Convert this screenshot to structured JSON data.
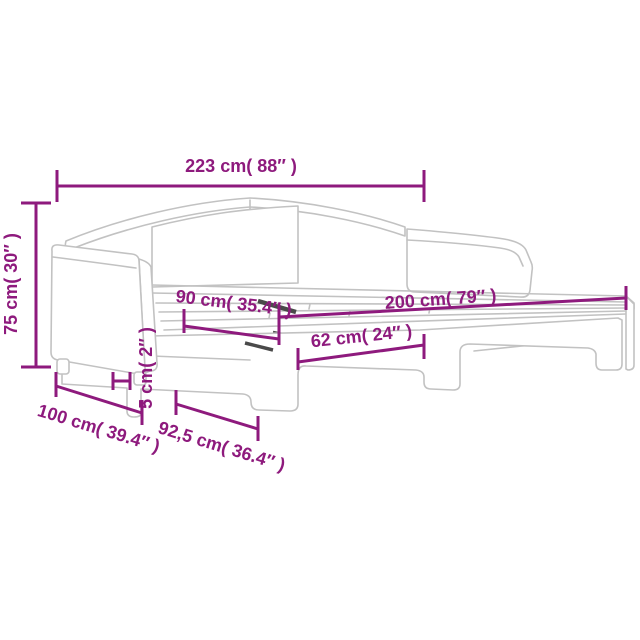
{
  "meta": {
    "dimension_color": "#8e1a7d",
    "line_art_color": "#c2c2c2",
    "dark_accent_color": "#4a4a4a",
    "background_color": "#ffffff"
  },
  "figure": {
    "dimensions": {
      "total_length": {
        "label": "223 cm( 88″ )"
      },
      "height": {
        "label": "75 cm( 30″ )"
      },
      "upper_mattress_width": {
        "label": "90 cm( 35.4″ )"
      },
      "mattress_length": {
        "label": "200 cm( 79″ )"
      },
      "leg_arch_span": {
        "label": "62 cm( 24″ )"
      },
      "depth": {
        "label": "100 cm( 39.4″ )"
      },
      "trundle_width": {
        "label": "92,5 cm( 36.4″ )"
      },
      "clearance": {
        "label": "5 cm( 2″ )"
      }
    }
  }
}
